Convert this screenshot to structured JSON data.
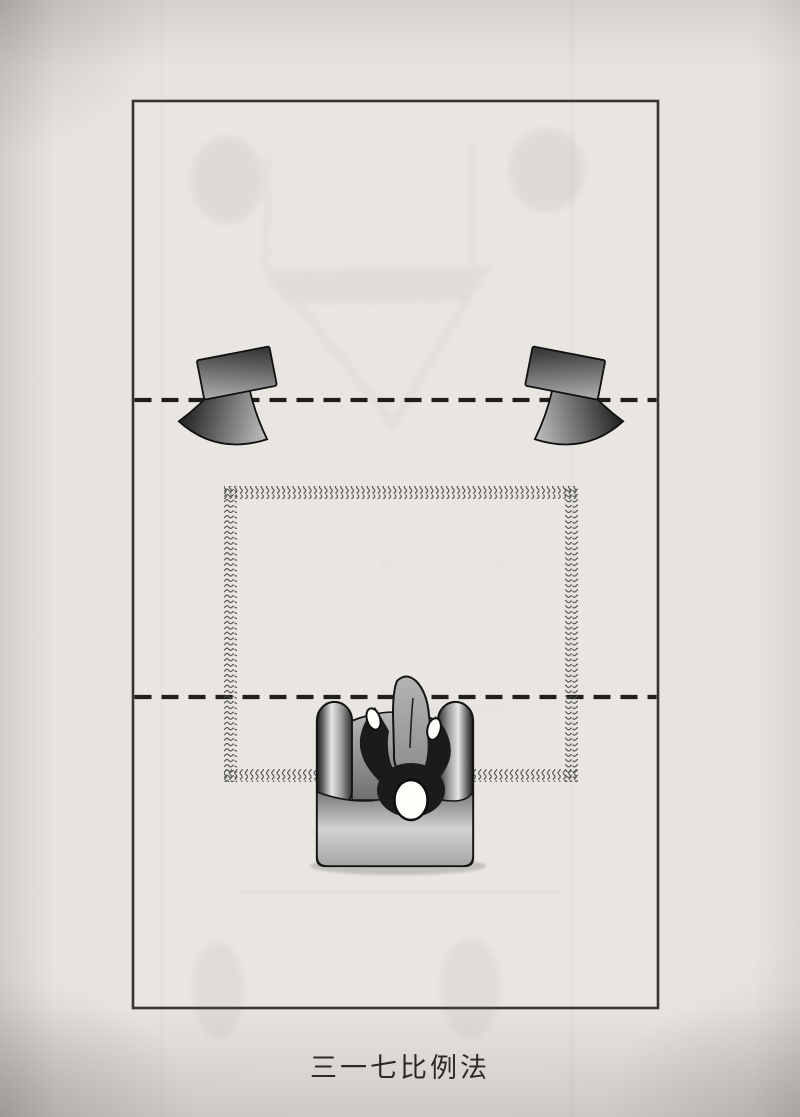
{
  "figure": {
    "caption": "三一七比例法",
    "kind": "top-view speaker placement diagram on a photographed book page"
  },
  "colors": {
    "paper": "#e7e4df",
    "room-fill": "#e9e6e1",
    "line-ink": "#38342f",
    "dash-ink": "#201e1b",
    "carpet-ink": "#4e4e4e",
    "caption-ink": "#2c2a26",
    "outline-ink": "#101010",
    "speaker-dark": "#3a3a3a",
    "speaker-light": "#a6a6a6",
    "cone-dark": "#262626",
    "cone-light": "#c2c2c2",
    "person-shirt": "#1b1b1b",
    "skin-white": "#fdfdfa",
    "bleed-ink": "#7a756f"
  }
}
